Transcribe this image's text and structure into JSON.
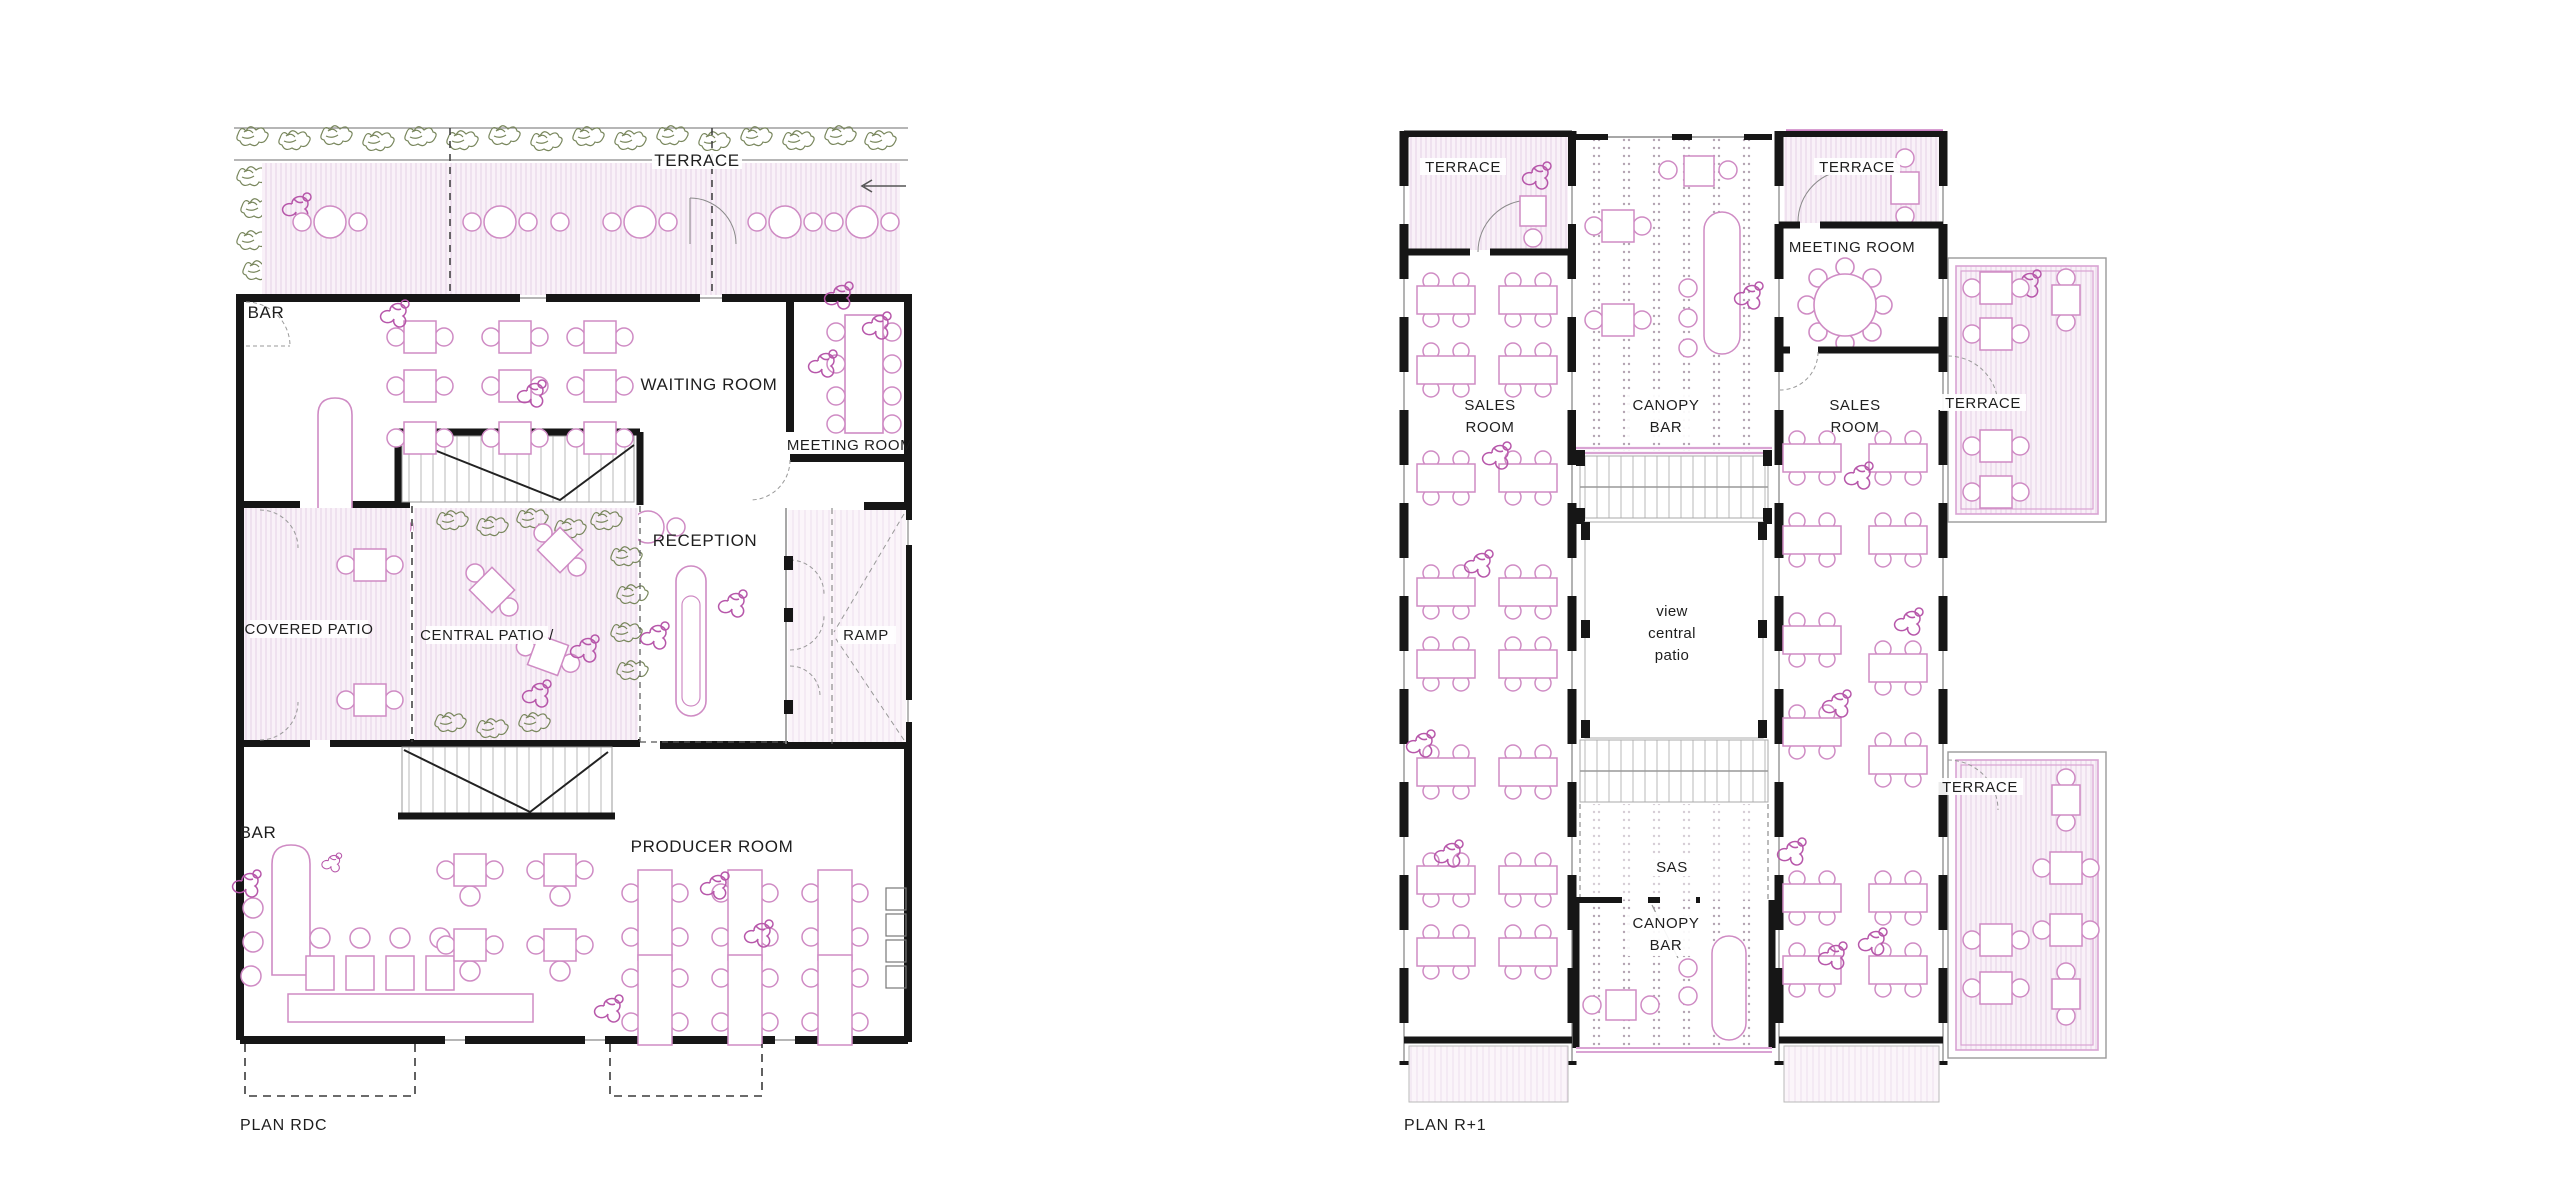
{
  "document": {
    "type": "architectural-floor-plans",
    "background": "#ffffff"
  },
  "colors": {
    "furniture_pink": "#cf8bc4",
    "person_magenta": "#b757aa",
    "hatch_fill": "#f9f1f8",
    "hatch_line": "#e9d7e9",
    "wall_black": "#161616",
    "plant_green": "#78865c",
    "stair_gray": "#b9b9b9",
    "dash_gray": "#3a3a3a",
    "accent_pink_wall": "#d9a3d3",
    "label_text": "#1e1e1e"
  },
  "plan_rdc": {
    "title": "PLAN RDC",
    "labels": {
      "terrace": "TERRACE",
      "bar_top": "BAR",
      "waiting_room": "WAITING ROOM",
      "meeting_room": "MEETING ROOM",
      "reception": "RECEPTION",
      "covered_patio": "COVERED PATIO",
      "central_patio": "CENTRAL PATIO /",
      "ramp": "RAMP",
      "bar_bottom": "BAR",
      "producer_room": "PRODUCER ROOM"
    }
  },
  "plan_r1": {
    "title": "PLAN R+1",
    "labels": {
      "terrace_top_left": "TERRACE",
      "terrace_top_right": "TERRACE",
      "meeting_room": "MEETING ROOM",
      "sales_left_1": "SALES",
      "sales_left_2": "ROOM",
      "canopy_top_1": "CANOPY",
      "canopy_top_2": "BAR",
      "sales_right_1": "SALES",
      "sales_right_2": "ROOM",
      "terrace_upper_right": "TERRACE",
      "view_1": "view",
      "view_2": "central",
      "view_3": "patio",
      "terrace_lower_right": "TERRACE",
      "sas": "SAS",
      "canopy_bottom_1": "CANOPY",
      "canopy_bottom_2": "BAR"
    }
  }
}
